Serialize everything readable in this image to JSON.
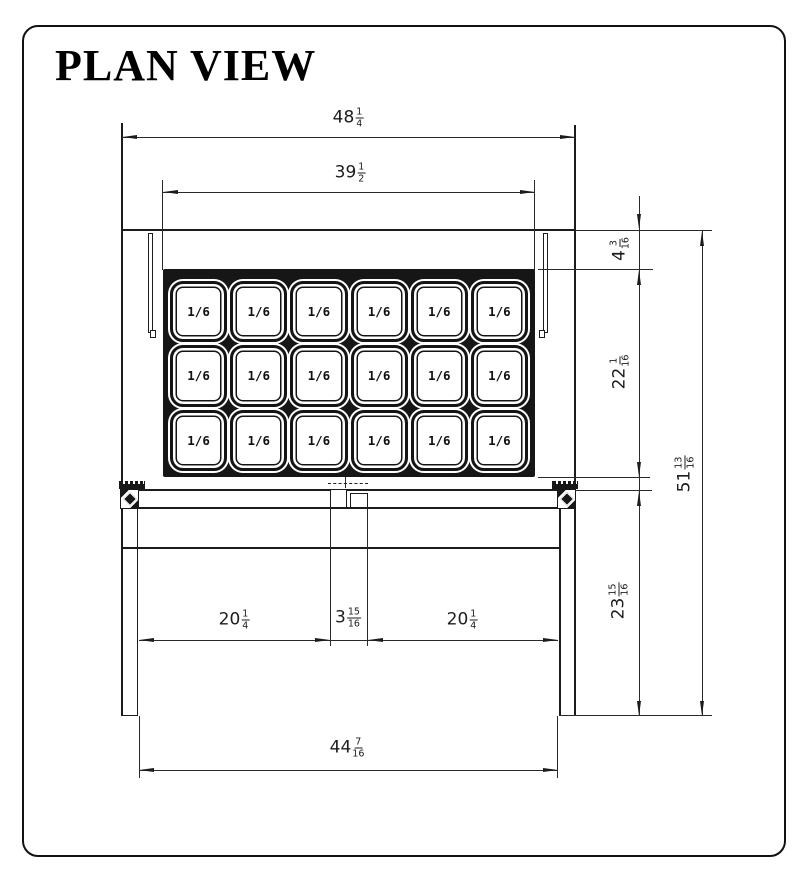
{
  "title": "PLAN VIEW",
  "pans": {
    "label": "1/6",
    "rows": 3,
    "cols": 6,
    "count": 18
  },
  "dimensions": {
    "top_width": {
      "whole": "48",
      "num": "1",
      "den": "4"
    },
    "pan_rail_width": {
      "whole": "39",
      "num": "1",
      "den": "2"
    },
    "rail_depth": {
      "whole": "4",
      "num": "3",
      "den": "16"
    },
    "pan_area_depth": {
      "whole": "22",
      "num": "1",
      "den": "16"
    },
    "board_depth": {
      "whole": "23",
      "num": "15",
      "den": "16"
    },
    "overall_depth": {
      "whole": "51",
      "num": "13",
      "den": "16"
    },
    "board_left_width": {
      "whole": "20",
      "num": "1",
      "den": "4"
    },
    "board_center_width": {
      "whole": "3",
      "num": "15",
      "den": "16"
    },
    "board_right_width": {
      "whole": "20",
      "num": "1",
      "den": "4"
    },
    "bottom_width": {
      "whole": "44",
      "num": "7",
      "den": "16"
    }
  },
  "colors": {
    "line": "#1c1c1c",
    "background": "#ffffff"
  }
}
